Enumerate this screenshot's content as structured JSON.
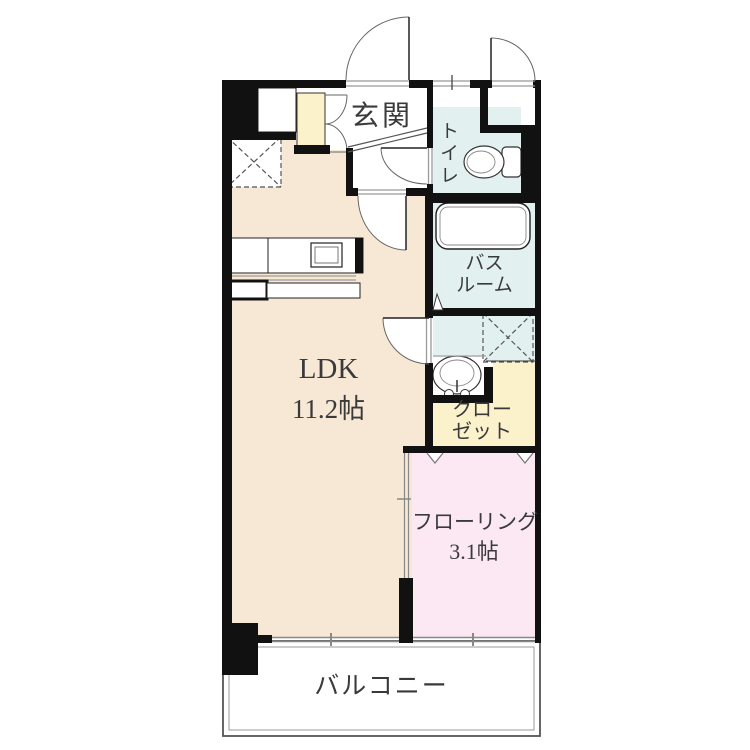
{
  "rooms": {
    "genkan": {
      "label": "玄関"
    },
    "toilet": {
      "label": "トイレ"
    },
    "bathroom": {
      "label_line1": "バス",
      "label_line2": "ルーム"
    },
    "ldk": {
      "label": "LDK",
      "area": "11.2帖"
    },
    "closet": {
      "label_line1": "クロー",
      "label_line2": "ゼット"
    },
    "flooring": {
      "label": "フローリング",
      "area": "3.1帖"
    },
    "balcony": {
      "label": "バルコニー"
    }
  },
  "fixtures": [
    "bathtub",
    "toilet-bowl",
    "washbasin",
    "kitchen-counter",
    "gas-stove",
    "shoe-cabinet",
    "refrigerator-space",
    "washing-machine-space",
    "entrance-door",
    "sliding-door",
    "balcony-windows"
  ],
  "colors": {
    "ldk_floor": "#f7e8d6",
    "wet_area": "#e2f1f0",
    "storage": "#fbf2cc",
    "bedroom": "#fbe8f3",
    "wall": "#111111",
    "line_gray": "#888888",
    "text": "#3a3a3a"
  }
}
